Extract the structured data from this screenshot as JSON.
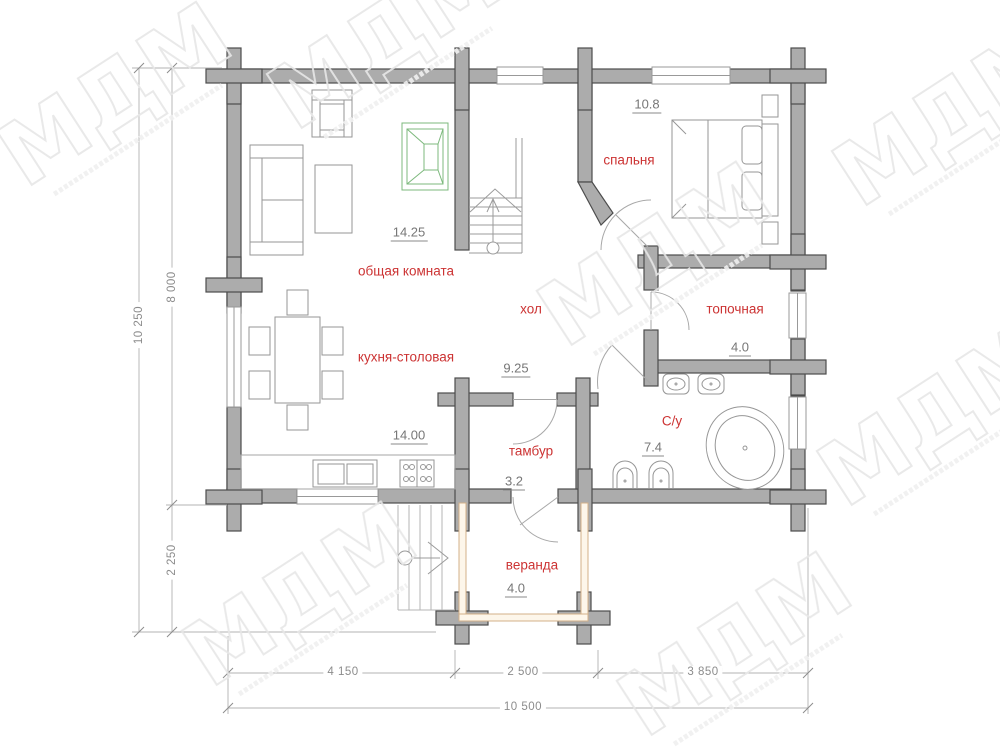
{
  "watermark": {
    "text": "МДМ"
  },
  "rooms": [
    {
      "name": "общая комната",
      "area": "14.25"
    },
    {
      "name": "спальня",
      "area": "10.8"
    },
    {
      "name": "хол",
      "area": "9.25"
    },
    {
      "name": "топочная",
      "area": "4.0"
    },
    {
      "name": "кухня-столовая",
      "area": "14.00"
    },
    {
      "name": "С/у",
      "area": "7.4"
    },
    {
      "name": "тамбур",
      "area": "3.2"
    },
    {
      "name": "веранда",
      "area": "4.0"
    }
  ],
  "dimensions": {
    "left": [
      "10 250",
      "8 000",
      "2 250"
    ],
    "bottom": [
      "4 150",
      "2 500",
      "3 850",
      "10 500"
    ]
  },
  "colors": {
    "wall_fill": "#acacac",
    "wall_outline": "#4d4d4d",
    "room_label_red": "#cc3333",
    "area_gray": "#777777",
    "dim_gray": "#8c8c8c",
    "fireplace_green": "#7cb87c",
    "veranda_tan": "#d3b088",
    "watermark_gray": "#e7e7e7"
  }
}
